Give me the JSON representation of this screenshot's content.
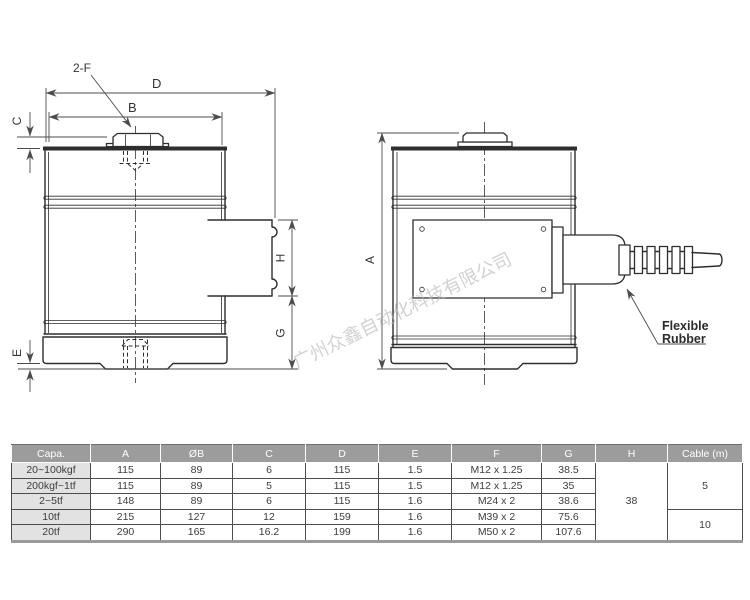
{
  "watermark": "广州众鑫自动化科技有限公司",
  "colors": {
    "line": "#2e2e2e",
    "dim": "#4c4c4c",
    "wm": "#b5b5b5",
    "hdr": "#9c9c9c",
    "cap": "#e2e2e2",
    "grid": "#4d4d4d"
  },
  "labels": {
    "bolt_callout": "2-F",
    "dim_d": "D",
    "dim_b": "B",
    "dim_c": "C",
    "dim_e": "E",
    "dim_h": "H",
    "dim_g": "G",
    "dim_a": "A",
    "rubber1": "Flexible",
    "rubber2": "Rubber"
  },
  "table": {
    "headers": [
      "Capa.",
      "A",
      "ØB",
      "C",
      "D",
      "E",
      "F",
      "G",
      "H",
      "Cable (m)"
    ],
    "rows": [
      {
        "capa": "20~100kgf",
        "a": "115",
        "b": "89",
        "c": "6",
        "d": "115",
        "e": "1.5",
        "f": "M12 x 1.25",
        "g": "38.5"
      },
      {
        "capa": "200kgf~1tf",
        "a": "115",
        "b": "89",
        "c": "5",
        "d": "115",
        "e": "1.5",
        "f": "M12 x 1.25",
        "g": "35"
      },
      {
        "capa": "2~5tf",
        "a": "148",
        "b": "89",
        "c": "6",
        "d": "115",
        "e": "1.6",
        "f": "M24 x 2",
        "g": "38.6"
      },
      {
        "capa": "10tf",
        "a": "215",
        "b": "127",
        "c": "12",
        "d": "159",
        "e": "1.6",
        "f": "M39 x 2",
        "g": "75.6"
      },
      {
        "capa": "20tf",
        "a": "290",
        "b": "165",
        "c": "16.2",
        "d": "199",
        "e": "1.6",
        "f": "M50 x 2",
        "g": "107.6"
      }
    ],
    "merged": {
      "h": "38",
      "cable_top": "5",
      "cable_bottom": "10"
    }
  }
}
